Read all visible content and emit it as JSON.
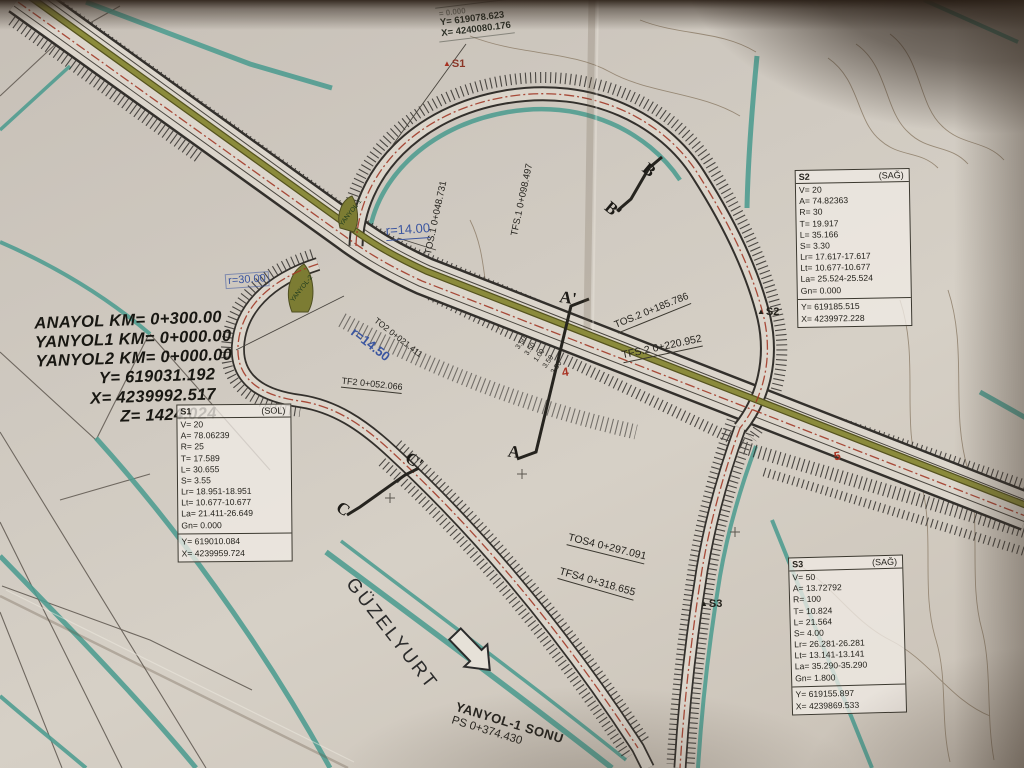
{
  "corner_ref": {
    "partial": "= 0.000",
    "y": "Y= 619078.623",
    "x": "X= 4240080.176"
  },
  "origin_block": {
    "anayol": "ANAYOL KM= 0+300.00",
    "yanyol1": "YANYOL1 KM= 0+000.00",
    "yanyol2": "YANYOL2 KM= 0+000.00",
    "y": "Y=  619031.192",
    "x": "X= 4239992.517",
    "z": "Z= 1424.024"
  },
  "tables": [
    {
      "id": "S1",
      "side": "(SOL)",
      "rows": [
        "V= 20",
        "A= 78.06239",
        "R= 25",
        "T= 17.589",
        "L= 30.655",
        "S= 3.55",
        "Lr= 18.951-18.951",
        "Lt= 10.677-10.677",
        "La= 21.411-26.649",
        "Gn= 0.000"
      ],
      "coords": [
        "Y= 619010.084",
        "X= 4239959.724"
      ]
    },
    {
      "id": "S2",
      "side": "(SAĞ)",
      "rows": [
        "V= 20",
        "A= 74.82363",
        "R= 30",
        "T= 19.917",
        "L= 35.166",
        "S= 3.30",
        "Lr= 17.617-17.617",
        "Lt= 10.677-10.677",
        "La= 25.524-25.524",
        "Gn= 0.000"
      ],
      "coords": [
        "Y= 619185.515",
        "X= 4239972.228"
      ]
    },
    {
      "id": "S3",
      "side": "(SAĞ)",
      "rows": [
        "V= 50",
        "A= 13.72792",
        "R= 100",
        "T= 10.824",
        "L= 21.564",
        "S= 4.00",
        "Lr= 26.281-26.281",
        "Lt= 13.141-13.141",
        "La= 35.290-35.290",
        "Gn= 1.800"
      ],
      "coords": [
        "Y= 619155.897",
        "X= 4239869.533"
      ]
    }
  ],
  "station_labels": {
    "tos1": "TOS.1 0+048.731",
    "tfs1": "TFS.1 0+098.497",
    "tos2": "TOS.2 0+185.786",
    "tfs2": "TFS.2 0+220.952",
    "tos4": "TOS4 0+297.091",
    "tfs4": "TFS4 0+318.655",
    "to2": "TO2 0+021.411",
    "tf2": "TF2 0+052.066"
  },
  "radius_labels": {
    "r14": "r=14.00",
    "r145": "r=14.50",
    "r30": "r=30.00"
  },
  "sections": {
    "a": "A",
    "a_prime": "A'",
    "b": "B",
    "b_prime": "B'",
    "c": "C",
    "c_prime": "C'"
  },
  "points": {
    "s1": "S1",
    "s2": "S2",
    "s3": "S3"
  },
  "direction_label": "GÜZELYURT",
  "end_label": {
    "line1": "YANYOL-1 SONU",
    "line2": "PS 0+374.430"
  },
  "island_labels": {
    "i1": "YANYOL-1",
    "i2": "YANYOL-2"
  },
  "lane_widths": [
    "3.50",
    "3.50",
    "1.00",
    "3.50",
    "3.50"
  ],
  "station_numbers": {
    "n4": "4",
    "n5": "5"
  },
  "colors": {
    "teal": "#4d9c90",
    "olive": "#7d7d33",
    "red_line": "#a23a28",
    "blue_note": "#3a55a0",
    "paper": "#cdc6bd",
    "ink": "#2e2c28"
  }
}
